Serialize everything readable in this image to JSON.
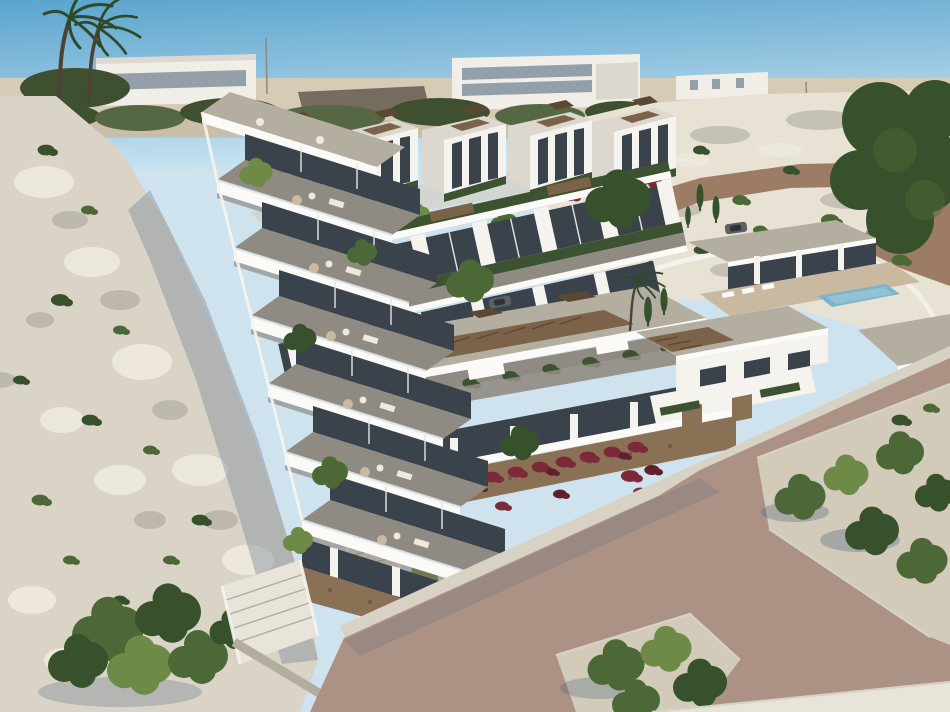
{
  "scene": {
    "title": "Aerial 3D render of a modern hillside residential development by the sea cliff",
    "description": "Computer-generated aerial view of a new-build complex: a seven-level terraced apartment block steps down a white rocky cliff on the left; behind it run two rows of white cubic townhouses with roof gardens and burgundy bougainvillea; a large flat-roofed building with a timber pergola sits at the center; on the right are detached villas, one with a small blue swimming pool; a pale rocky slope with a winding dirt road rises at the top right; two wind-blown palm trees and distant white buildings stand on the horizon; a wide dusty-rose road with grey kerbs, pavements and two landscaped planting beds fills the foreground.",
    "setting": "coastal hillside, clear sunny sky, light from upper right",
    "counts": {
      "terrace_levels": 7,
      "back_row_houses": 5,
      "mid_row_units": 6,
      "villas": 3,
      "swimming_pools": 1,
      "palm_trees_skyline": 2,
      "planting_beds": 2,
      "cars": 2,
      "staircases": 2
    }
  },
  "palette": {
    "sky_top": "#5aa4ce",
    "sky_horizon": "#c9e3f0",
    "sand": "#d6cbb5",
    "sand_dark": "#c3b6a0",
    "distant_white": "#f0eee7",
    "distant_glass": "#93a0a7",
    "distant_roof": "#766d60",
    "hill_green": "#566843",
    "hill_green_dark": "#3e5030",
    "palm_green": "#2f4a28",
    "trunk": "#4e4236",
    "rock_light": "#e7e2d4",
    "rock_mid": "#d3ccbc",
    "rock_shadow": "#aaa79a",
    "road_hill": "#9c7c64",
    "cliff": "#dad4c7",
    "cliff_patch": "#efeade",
    "cliff_shadow": "#7e8e9b",
    "tree_green": "#4d6837",
    "tree_light": "#6d8a47",
    "tree_dark": "#36512b",
    "hedge": "#3d5230",
    "white": "#f5f3ee",
    "white_shade": "#dcd8cf",
    "fascia": "#fbfaf6",
    "glaz": "#3a424b",
    "glaz_light": "#59646c",
    "deck": "#8f8b82",
    "deck_light": "#b4aea1",
    "pergola": "#7b6248",
    "pergola_dark": "#5c4832",
    "stone": "#8a7156",
    "stone_dark": "#6d5940",
    "bougainvillea": "#7c2a39",
    "bougainvillea_dark": "#5f1f2c",
    "road": "#ab9285",
    "curb": "#d7d2c4",
    "gravel": "#d2cbba",
    "pave": "#e8e4d9",
    "pool": "#7cb3cb",
    "pool_light": "#a3ccdc",
    "furniture": "#c8b9a0",
    "furniture_light": "#efe9dd",
    "railing": "#dde7ec",
    "shadow": "#3f5a74",
    "car": "#5a6066",
    "car_glass": "#2e3338",
    "wall_grey": "#b3ada0",
    "pole": "#8a8a85"
  }
}
